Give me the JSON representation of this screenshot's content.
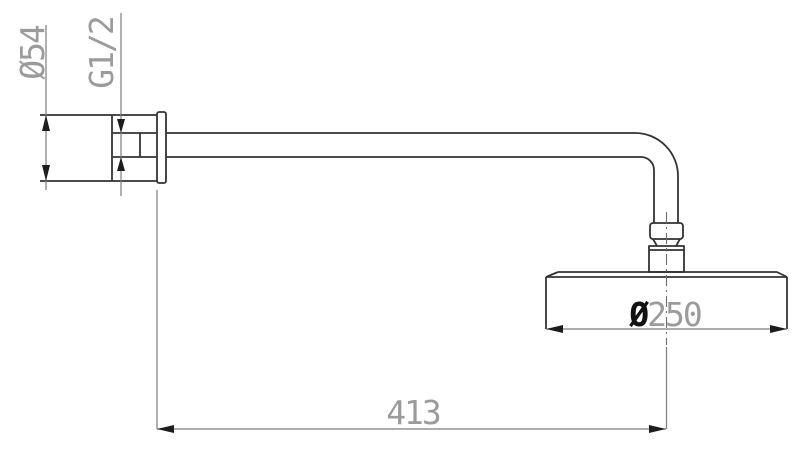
{
  "drawing": {
    "type": "technical-dimension-drawing",
    "subject": "wall-mounted rain shower head with shower arm, side view",
    "colors": {
      "background": "#ffffff",
      "outline": "#333333",
      "dimension_lines": "#7d7d7d",
      "dimension_text": "#9b9b9b",
      "emphasis_symbol": "#111111",
      "arrowheads": "#1c1c1c"
    }
  },
  "labels": {
    "flange_diameter": "Ø54",
    "thread_size": "G1/2",
    "head_diameter_symbol": "Ø",
    "head_diameter_value": "250",
    "arm_length": "413"
  }
}
